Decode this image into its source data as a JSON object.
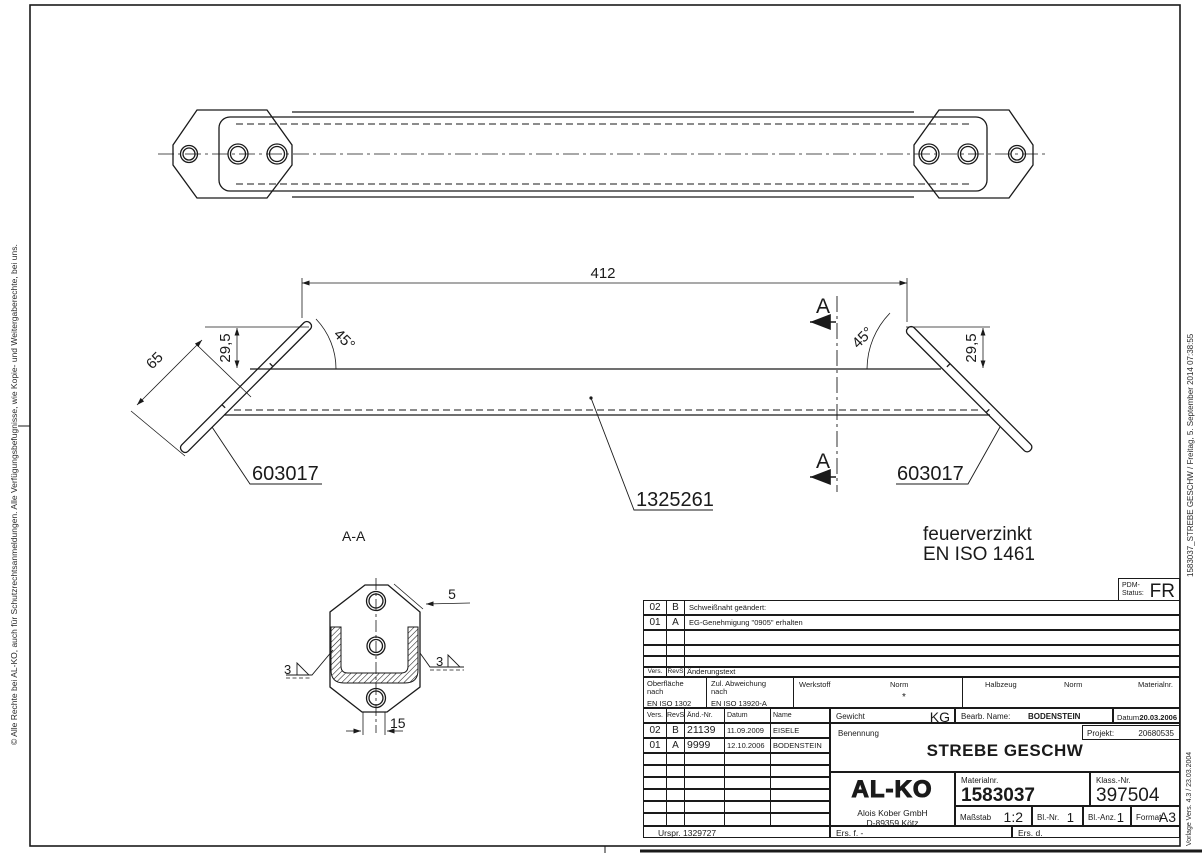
{
  "margins": {
    "left_text": "© Alle Rechte bei AL-KO, auch für Schutzrechtsanmeldungen. Alle Verfügungsbefugnisse, wie Kopie- und Weitergaberechte, bei uns.",
    "right_text": "1583037_STREBE GESCHW  / Freitag, 5. September 2014 07:38:55",
    "template_version": "Vorlage Vers. 4.3 / 23.03.2004"
  },
  "drawing": {
    "dim_412": "412",
    "dim_45_left": "45°",
    "dim_45_right": "45°",
    "dim_29_5_left": "29,5",
    "dim_29_5_right": "29,5",
    "dim_65": "65",
    "part_left": "603017",
    "part_right": "603017",
    "part_center": "1325261",
    "section_letter_top": "A",
    "section_letter_bottom": "A",
    "section_view_title": "A-A",
    "dim_5": "5",
    "dim_15": "15",
    "weld_left": "3",
    "weld_right": "3",
    "note_line1": "feuerverzinkt",
    "note_line2": "EN ISO 1461"
  },
  "pdm": {
    "label": "PDM-Status:",
    "value": "FR"
  },
  "revisions": {
    "header": {
      "vers": "Vers.",
      "rev": "RevS",
      "text": "Änderungstext"
    },
    "rows": [
      {
        "vers": "02",
        "rev": "B",
        "text": "Schweißnaht geändert:"
      },
      {
        "vers": "01",
        "rev": "A",
        "text": "EG-Genehmigung \"0905\" erhalten"
      }
    ]
  },
  "specs": {
    "surface_label1": "Oberfläche",
    "surface_label2": "nach",
    "surface_value": "EN ISO 1302",
    "deviation_label1": "Zul. Abweichung",
    "deviation_label2": "nach",
    "deviation_value": "EN ISO 13920-A",
    "werkstoff_label": "Werkstoff",
    "werkstoff_norm_label": "Norm",
    "werkstoff_value": "*",
    "halbzeug_label": "Halbzeug",
    "halbzeug_norm_label": "Norm",
    "materialnr_label": "Materialnr."
  },
  "changes": {
    "headers": {
      "vers": "Vers.",
      "rev": "RevS",
      "nr": "Änd.-Nr.",
      "datum": "Datum",
      "name": "Name"
    },
    "rows": [
      {
        "vers": "02",
        "rev": "B",
        "nr": "21139",
        "datum": "11.09.2009",
        "name": "EISELE"
      },
      {
        "vers": "01",
        "rev": "A",
        "nr": "9999",
        "datum": "12.10.2006",
        "name": "BODENSTEIN"
      }
    ]
  },
  "title_block": {
    "gewicht_label": "Gewicht",
    "gewicht_unit": "KG",
    "bearb_label": "Bearb. Name:",
    "bearb_value": "BODENSTEIN",
    "datum_label": "Datum:",
    "datum_value": "20.03.2006",
    "benennung_label": "Benennung",
    "projekt_label": "Projekt:",
    "projekt_value": "20680535",
    "part_name": "STREBE GESCHW",
    "logo_text": "AL-KO",
    "company_line1": "Alois Kober GmbH",
    "company_line2": "D-89359 Kötz",
    "materialnr_label": "Materialnr.",
    "materialnr_value": "1583037",
    "klassnr_label": "Klass.-Nr.",
    "klassnr_value": "397504",
    "massstab_label": "Maßstab",
    "massstab_value": "1:2",
    "blnr_label": "Bl.-Nr.",
    "blnr_value": "1",
    "blanz_label": "Bl.-Anz.",
    "blanz_value": "1",
    "format_label": "Format",
    "format_value": "A3",
    "urspr": "Urspr. 1329727",
    "ers_f": "Ers. f. -",
    "ers_d": "Ers. d."
  }
}
